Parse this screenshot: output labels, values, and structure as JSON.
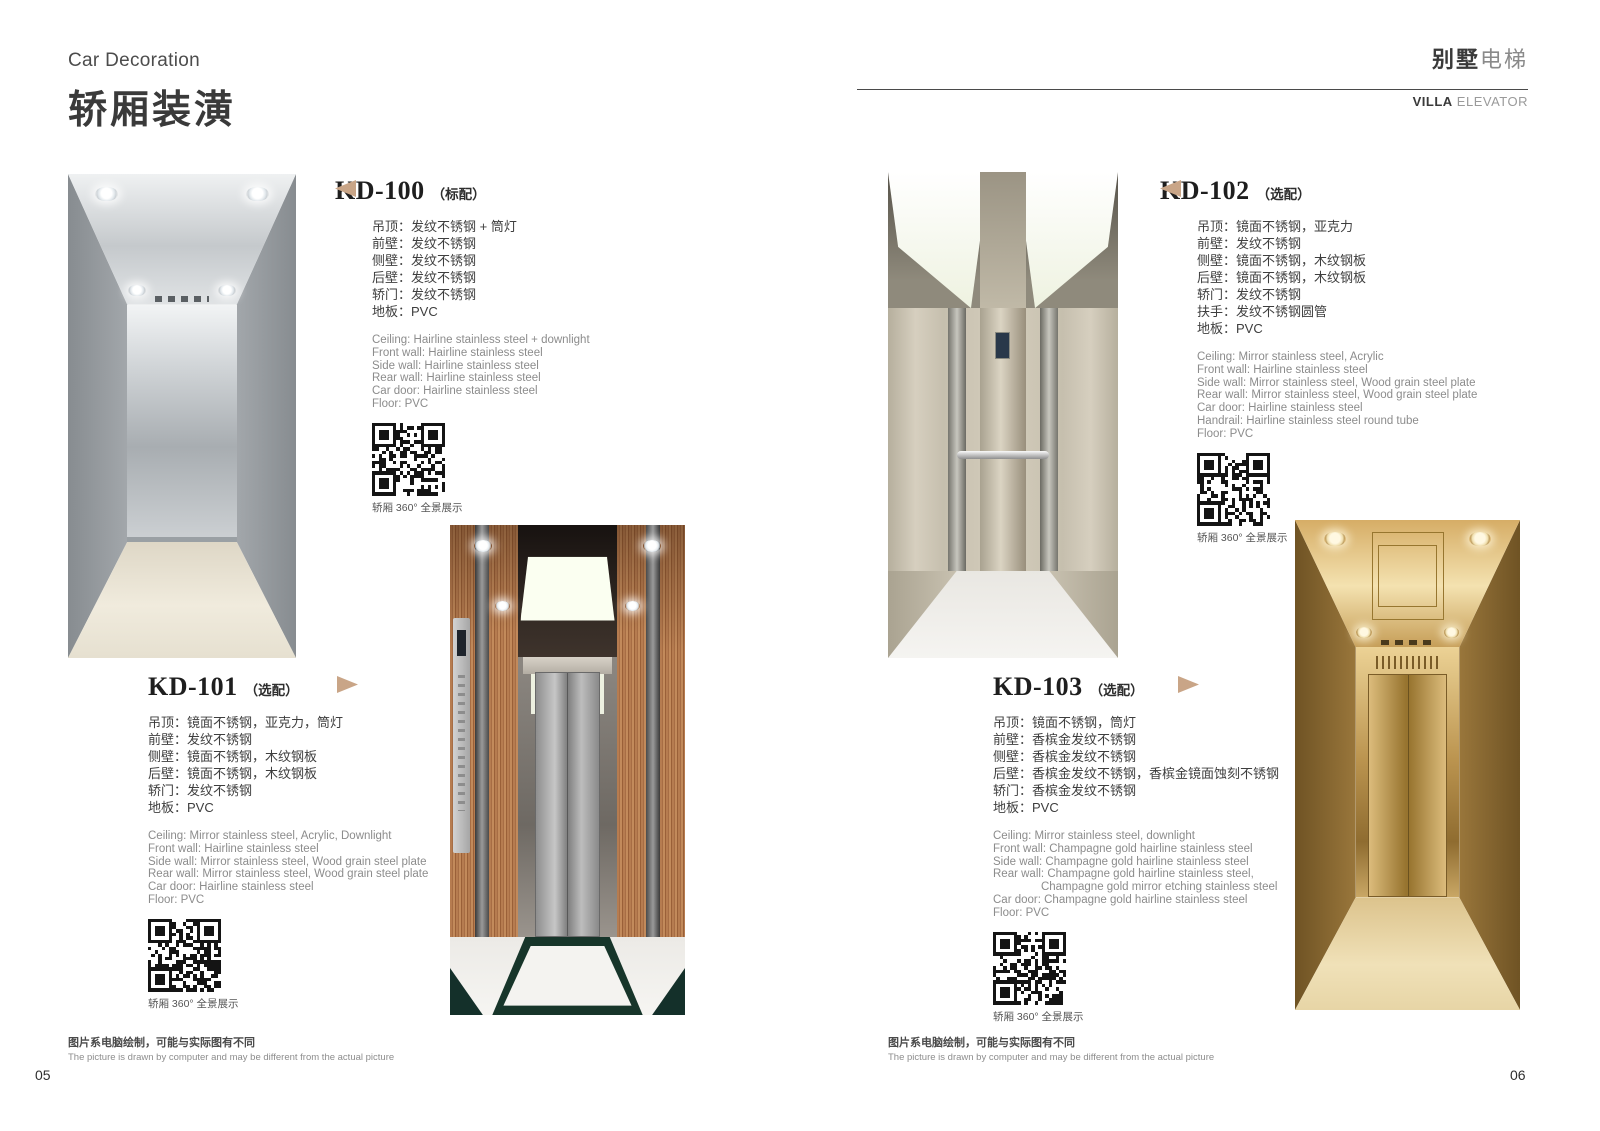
{
  "accent_color": "#c9a587",
  "qr_caption": "轿厢 360° 全景展示",
  "header_left": {
    "subtitle_en": "Car Decoration",
    "title_zh": "轿厢装潢"
  },
  "header_right": {
    "zh_bold": "别墅",
    "zh_light": "电梯",
    "en_bold": "VILLA",
    "en_light": " ELEVATOR"
  },
  "footer": {
    "disclaimer_zh": "图片系电脑绘制，可能与实际图有不同",
    "disclaimer_en": "The picture is drawn by computer and may be different from the actual picture",
    "page_left": "05",
    "page_right": "06"
  },
  "products": [
    {
      "model": "KD-100",
      "variant": "（标配）",
      "specs_zh": [
        "吊顶：发纹不锈钢 + 筒灯",
        "前壁：发纹不锈钢",
        "侧壁：发纹不锈钢",
        "后壁：发纹不锈钢",
        "轿门：发纹不锈钢",
        "地板：PVC"
      ],
      "specs_en": [
        "Ceiling: Hairline stainless steel + downlight",
        "Front wall: Hairline stainless steel",
        "Side wall: Hairline stainless steel",
        "Rear wall: Hairline stainless steel",
        "Car door: Hairline stainless steel",
        "Floor: PVC"
      ]
    },
    {
      "model": "KD-101",
      "variant": "（选配）",
      "specs_zh": [
        "吊顶：镜面不锈钢，亚克力，筒灯",
        "前壁：发纹不锈钢",
        "侧壁：镜面不锈钢，木纹钢板",
        "后壁：镜面不锈钢，木纹钢板",
        "轿门：发纹不锈钢",
        "地板：PVC"
      ],
      "specs_en": [
        "Ceiling: Mirror stainless steel, Acrylic, Downlight",
        "Front wall: Hairline stainless steel",
        "Side wall: Mirror stainless steel, Wood grain steel plate",
        "Rear wall: Mirror stainless steel, Wood grain steel plate",
        "Car door: Hairline stainless steel",
        "Floor: PVC"
      ]
    },
    {
      "model": "KD-102",
      "variant": "（选配）",
      "specs_zh": [
        "吊顶：镜面不锈钢，亚克力",
        "前壁：发纹不锈钢",
        "侧壁：镜面不锈钢，木纹钢板",
        "后壁：镜面不锈钢，木纹钢板",
        "轿门：发纹不锈钢",
        "扶手：发纹不锈钢圆管",
        "地板：PVC"
      ],
      "specs_en": [
        "Ceiling: Mirror stainless steel, Acrylic",
        "Front wall: Hairline stainless steel",
        "Side wall: Mirror stainless steel, Wood grain steel plate",
        "Rear wall: Mirror stainless steel, Wood grain steel plate",
        "Car door: Hairline stainless steel",
        "Handrail: Hairline stainless steel round tube",
        "Floor: PVC"
      ]
    },
    {
      "model": "KD-103",
      "variant": "（选配）",
      "specs_zh": [
        "吊顶：镜面不锈钢，筒灯",
        "前壁：香槟金发纹不锈钢",
        "侧壁：香槟金发纹不锈钢",
        "后壁：香槟金发纹不锈钢，香槟金镜面蚀刻不锈钢",
        "轿门：香槟金发纹不锈钢",
        "地板：PVC"
      ],
      "specs_en": [
        "Ceiling: Mirror stainless steel, downlight",
        "Front wall: Champagne gold hairline stainless steel",
        "Side wall: Champagne gold hairline stainless steel",
        "Rear wall: Champagne gold hairline stainless steel,",
        "               Champagne gold mirror etching stainless steel",
        "Car door: Champagne gold hairline stainless steel",
        "Floor: PVC"
      ]
    }
  ]
}
